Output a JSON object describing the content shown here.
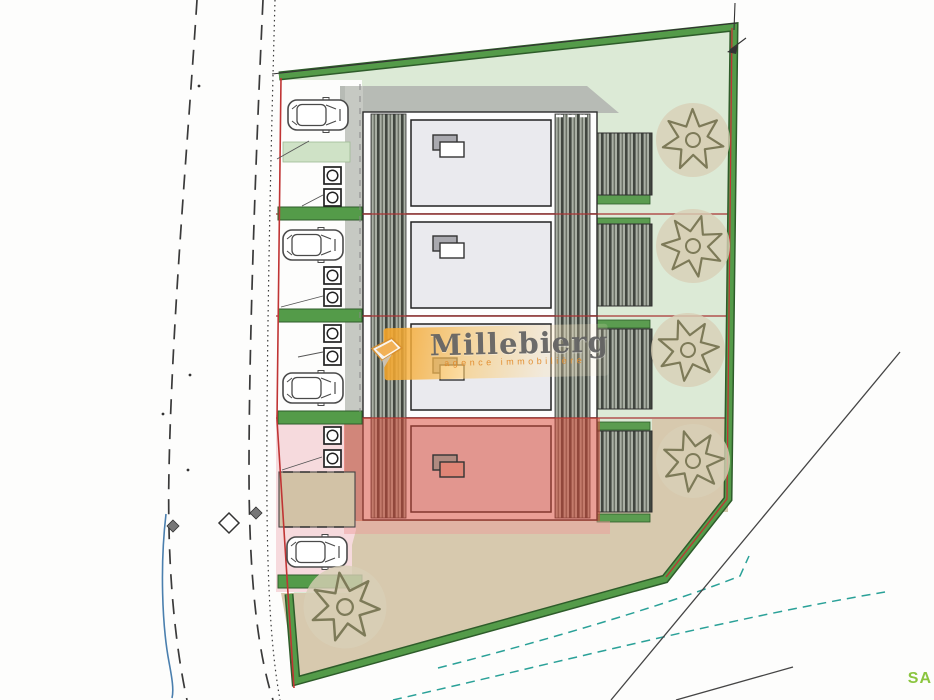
{
  "watermark": {
    "title": "Millebierg",
    "subtitle": "agence immobilière"
  },
  "corner_label": "SA",
  "plan": {
    "type": "residential-site-plan",
    "units": [
      {
        "id": "unit-1",
        "highlighted": false
      },
      {
        "id": "unit-2",
        "highlighted": false
      },
      {
        "id": "unit-3",
        "highlighted": false
      },
      {
        "id": "unit-4",
        "highlighted": true
      }
    ],
    "car_count": 4,
    "tree_count": 5
  },
  "colors": {
    "plot-green": "#dcead6",
    "hedge-green": "#549b49",
    "hedge-dark": "#2e5c2a",
    "lawn-stripe": "#5b9c50",
    "lawn-stripe-light": "#cfe2c6",
    "beige": "#d7c9ae",
    "patio-beige": "#d2c2a6",
    "pink": "#f6dadd",
    "unit-red": "rgba(219,72,56,0.52)",
    "pink-band": "rgba(238,152,152,0.45)",
    "boundary-red": "#c03434",
    "division-red": "#a83434",
    "roof-fill": "#eaeaee",
    "shadow-gray": "#b7bbb5",
    "walkway-gray": "#c6c9c3",
    "deck-base": "#a9afa4",
    "deck-dark": "#41463f",
    "teal": "#2aa198",
    "tree-fill": "#d8cfb6",
    "tree-line": "#7d7a58",
    "sa-green": "#8bc53f",
    "road-line": "#3a3a3a",
    "blue-line": "#4a7fae"
  }
}
